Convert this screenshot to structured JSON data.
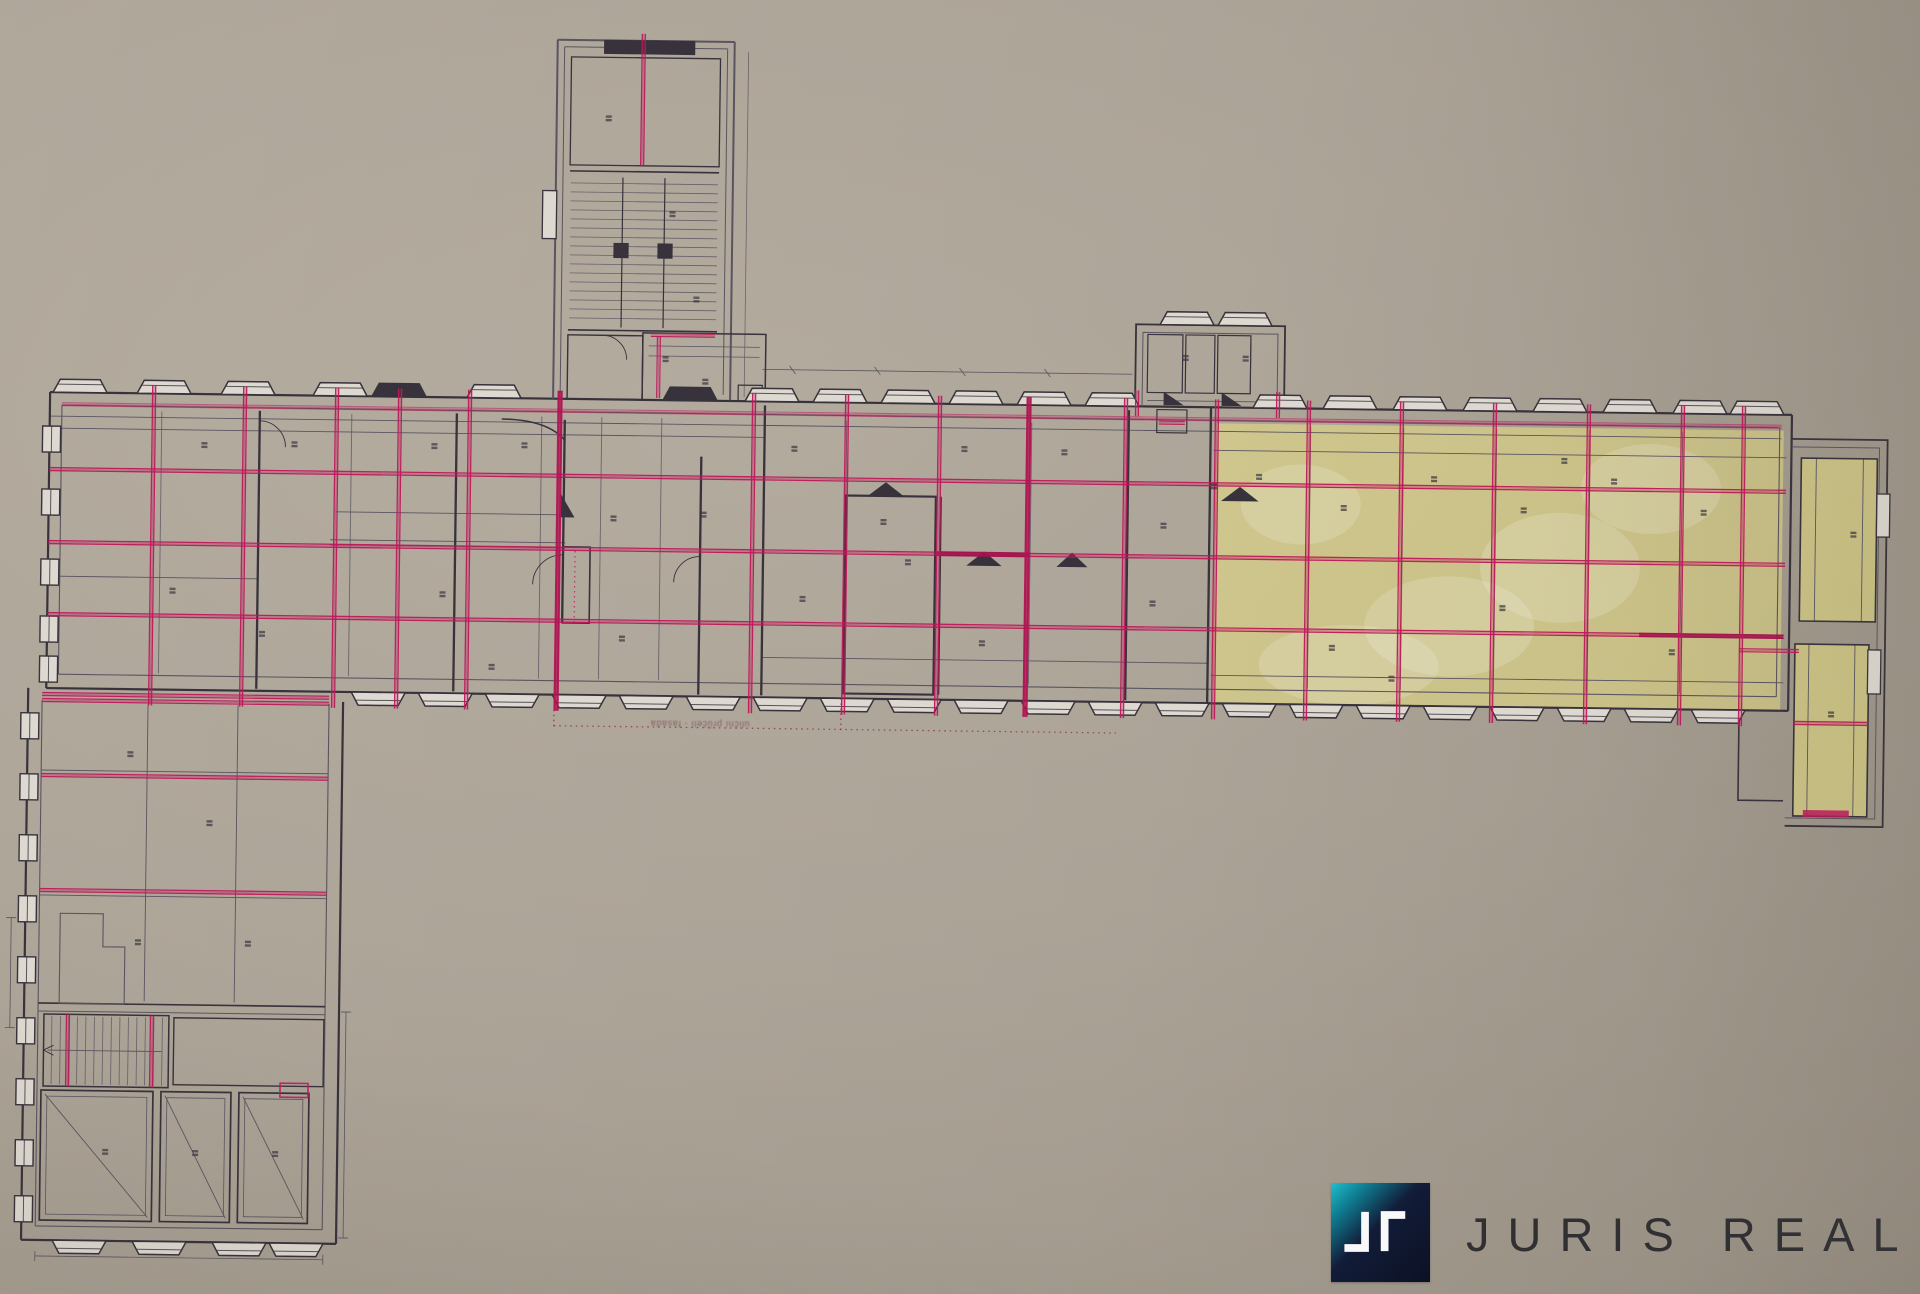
{
  "page": {
    "background": "#d1ccc4"
  },
  "plan": {
    "caption": "uliční průčelí - fasáda",
    "colors": {
      "paper": "#d3cec6",
      "paper_light": "#ddd8d0",
      "wall": "#37323b",
      "thin": "#5a5460",
      "pink": "#c2185b",
      "pink_strong": "#a8104e",
      "yellow": "#efe57b",
      "label": "#3c3741"
    },
    "sections": [
      {
        "name": "stair-tower"
      },
      {
        "name": "main-wing"
      },
      {
        "name": "highlighted-hall"
      },
      {
        "name": "left-wing"
      },
      {
        "name": "right-wing"
      },
      {
        "name": "annex"
      }
    ]
  },
  "logo": {
    "words": [
      "JURIS",
      "REAL"
    ],
    "tile_colors": {
      "teal": "#1ec0cc",
      "navy": "#0c1124"
    },
    "text_color": "#303033"
  }
}
